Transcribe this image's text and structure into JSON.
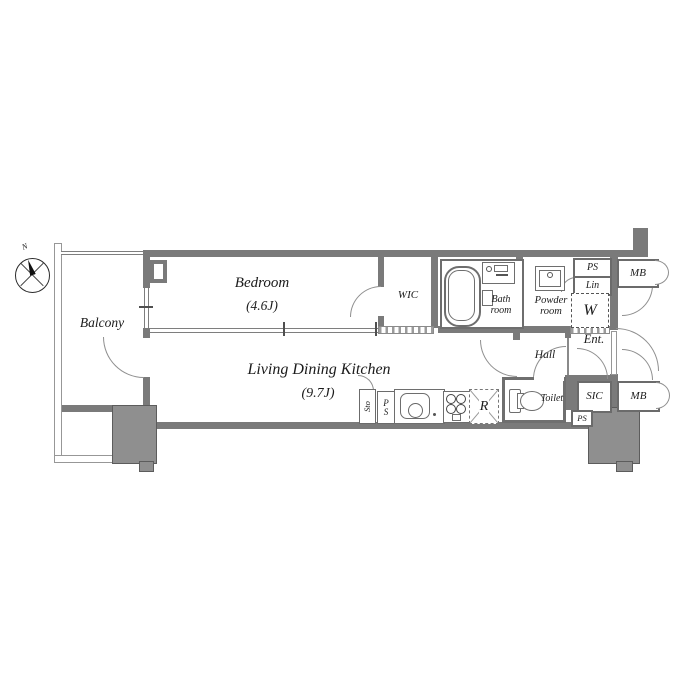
{
  "compass": {
    "north_label": "N"
  },
  "rooms": {
    "balcony": {
      "label": "Balcony"
    },
    "bedroom": {
      "label": "Bedroom",
      "size": "(4.6J)"
    },
    "wic": {
      "label": "WIC"
    },
    "bathroom": {
      "label": "Bath room"
    },
    "powder": {
      "label": "Powder room"
    },
    "ldk": {
      "label": "Living Dining Kitchen",
      "size": "(9.7J)"
    },
    "hall": {
      "label": "Hall"
    },
    "entrance": {
      "label": "Ent."
    },
    "toilet": {
      "label": "Toilet"
    },
    "sic": {
      "label": "SIC"
    }
  },
  "fixtures": {
    "ps_top": "PS",
    "linen": "Lin",
    "washer": "W",
    "mb_top": "MB",
    "mb_bottom": "MB",
    "ps_bottom": "PS",
    "storage": "Sto",
    "ps_kitchen_p": "P",
    "ps_kitchen_s": "S",
    "refrigerator": "R"
  },
  "colors": {
    "wall": "#7a7a7a",
    "pillar": "#8f8f8f",
    "line": "#8a8a8a",
    "text": "#1b1b1b",
    "background": "#ffffff"
  }
}
